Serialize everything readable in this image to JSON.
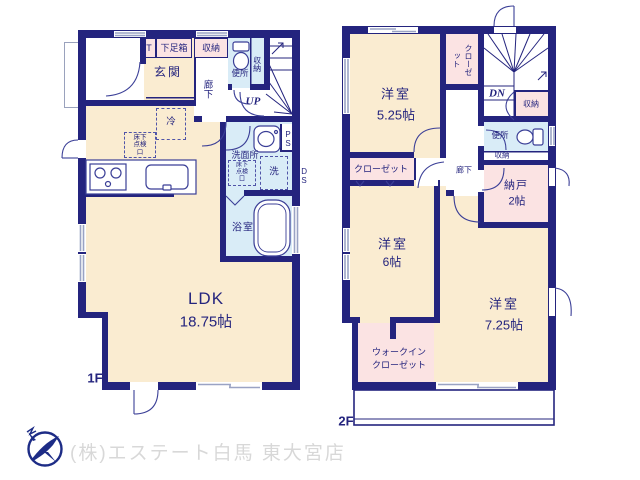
{
  "colors": {
    "wall_navy": "#24247E",
    "room_cream": "#FAECD1",
    "closet_pink": "#FBE3E3",
    "wet_area_blue": "#D9ECF7",
    "window_gray": "#9AA3C4",
    "fixture_navy": "#3B3F97",
    "logo_navy": "#1D2C86",
    "footer_text_gray": "#D8D8D8"
  },
  "floor1": {
    "label": "1F",
    "labels": {
      "t": "T",
      "shoe_box": "下足箱",
      "storage_top": "収納",
      "entrance": "玄関",
      "hallway": "廊下",
      "toilet": "便所",
      "storage_wc": "収納",
      "up": "UP",
      "fridge": "冷",
      "underfloor_hatch": "床下点検口",
      "washroom": "洗面所",
      "underfloor_hatch2": "床下点検口",
      "laundry": "洗",
      "ps": "PS",
      "ds": "DS",
      "bathroom": "浴室",
      "ldk_name": "LDK",
      "ldk_size": "18.75帖"
    }
  },
  "floor2": {
    "label": "2F",
    "labels": {
      "room1_name": "洋室",
      "room1_size": "5.25帖",
      "closet_vertical": "クローゼット",
      "dn": "DN",
      "storage_stairs": "収納",
      "toilet": "便所",
      "storage_wc": "収納",
      "hallway": "廊下",
      "storage_room_name": "納戸",
      "storage_room_size": "2帖",
      "closet": "クローゼット",
      "room2_name": "洋室",
      "room2_size": "6帖",
      "room3_name": "洋室",
      "room3_size": "7.25帖",
      "wic_line1": "ウォークイン",
      "wic_line2": "クローゼット"
    }
  },
  "footer": {
    "company": "(株)エステート白馬 東大宮店"
  }
}
